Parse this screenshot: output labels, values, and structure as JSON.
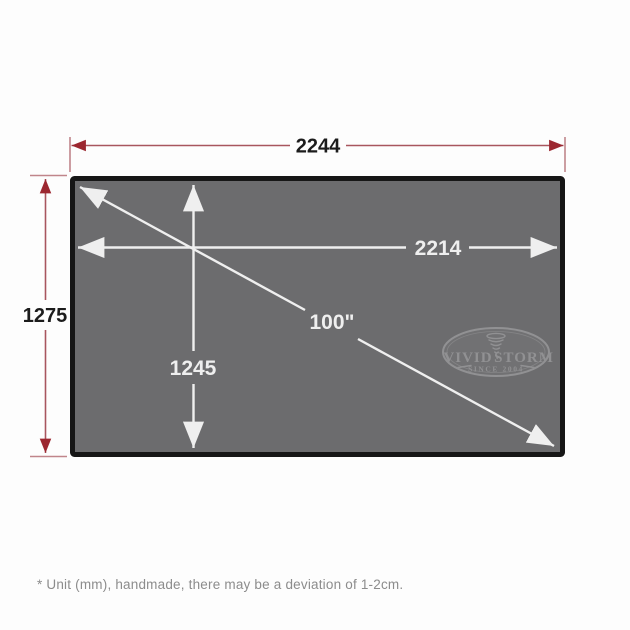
{
  "colors": {
    "background": "#fdfdfd",
    "dimension-line-red": "#a8565e",
    "dimension-arrow-red": "#9c2730",
    "dimension-text": "#1c1c1c",
    "screen-fill": "#6c6c6e",
    "screen-border": "#161616",
    "inner-line-white": "#efefef",
    "watermark": "#98989a",
    "note-text": "#8c8c8c"
  },
  "outer_dimensions": {
    "width_label": "2244",
    "height_label": "1275"
  },
  "screen": {
    "viewing_width_label": "2214",
    "viewing_height_label": "1245",
    "diagonal_label": "100\""
  },
  "logo": {
    "brand_left": "VIVID",
    "brand_right": "STORM",
    "tagline": "SINCE 2004"
  },
  "footnote": {
    "text": "* Unit (mm), handmade, there may be a deviation of 1-2cm."
  }
}
